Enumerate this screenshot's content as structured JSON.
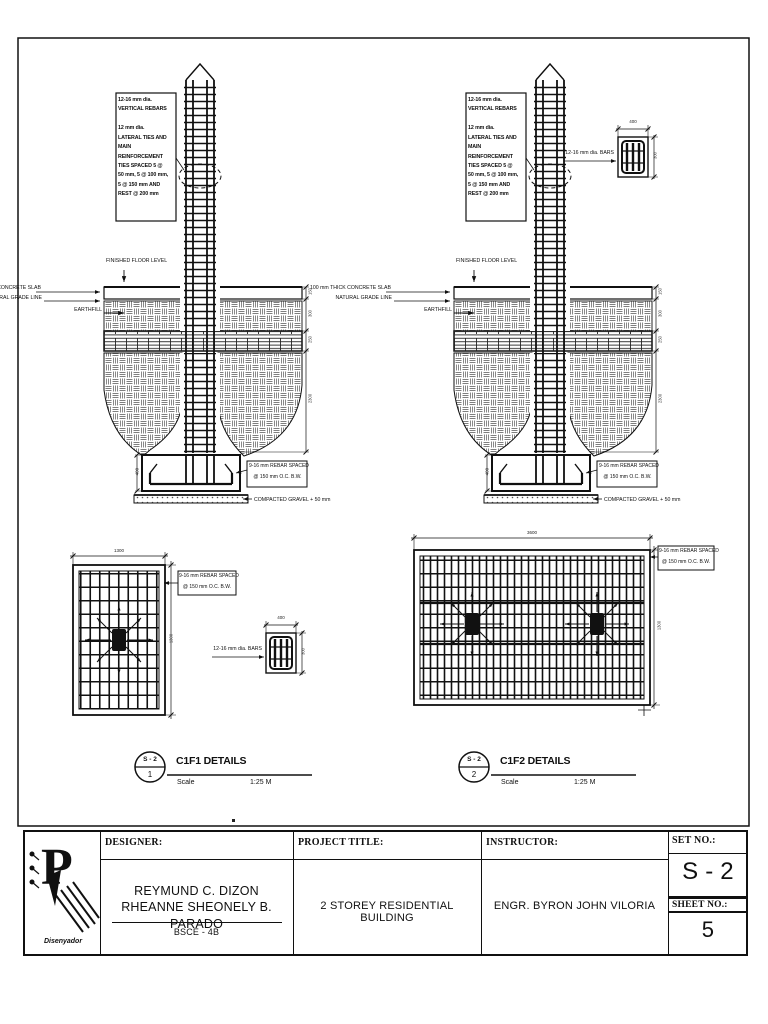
{
  "drawing": {
    "note_box": "12-16 mm dia.\nVERTICAL REBARS\n\n12 mm dia.\nLATERAL TIES AND\nMAIN\nREINFORCEMENT\nTIES SPACED 5 @\n50 mm, 5 @ 100 mm,\n5 @ 150 mm AND\nREST @ 200 mm",
    "labels": {
      "finished_floor_level": "FINISHED FLOOR LEVEL",
      "concrete_slab": "100 mm THICK CONCRETE SLAB",
      "natural_grade_line": "NATURAL GRADE LINE",
      "earthfill": "EARTHFILL",
      "footing_rebar_line1": "9-16 mm REBAR SPACED",
      "footing_rebar_line2": "@ 150 mm O.C.  B.W.",
      "compacted_gravel": "COMPACTED GRAVEL + 50 mm",
      "column_bars": "12-16 mm dia. BARS"
    },
    "dims": {
      "footing_depth": "400",
      "section_width": "400",
      "section_height": "300",
      "plan1_width": "1300",
      "plan1_height": "1300",
      "plan2_width": "3600",
      "plan2_height": "1300",
      "side_d1": "150",
      "side_d2": "300",
      "side_d3": "250",
      "side_d4": "2300"
    },
    "details": [
      {
        "bubble_top": "S - 2",
        "bubble_num": "1",
        "title": "C1F1 DETAILS",
        "scale_label": "Scale",
        "scale_value": "1:25 M"
      },
      {
        "bubble_top": "S - 2",
        "bubble_num": "2",
        "title": "C1F2 DETAILS",
        "scale_label": "Scale",
        "scale_value": "1:25 M"
      }
    ]
  },
  "title_block": {
    "designer_label": "DESIGNER:",
    "designer_names": "REYMUND C. DIZON\nRHEANNE SHEONELY B. PARADO",
    "designer_section": "BSCE - 4B",
    "project_label": "PROJECT TITLE:",
    "project_title": "2 STOREY RESIDENTIAL BUILDING",
    "instructor_label": "INSTRUCTOR:",
    "instructor_name": "ENGR. BYRON  JOHN VILORIA",
    "set_label": "SET NO.:",
    "set_no": "S - 2",
    "sheet_label": "SHEET NO.:",
    "sheet_no": "5",
    "logo_text": "Disenyador"
  }
}
